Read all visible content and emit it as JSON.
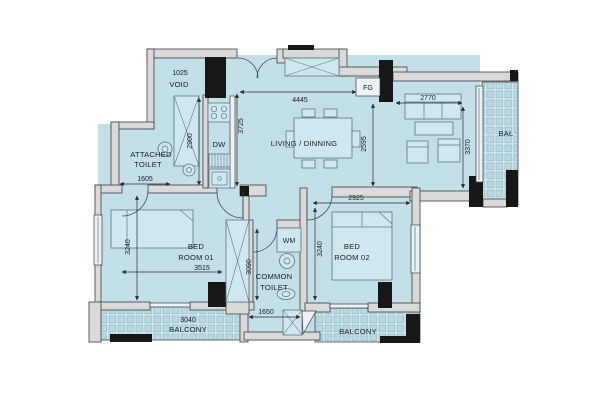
{
  "plan": {
    "rooms": {
      "void": {
        "dim": "1025",
        "label": "VOID"
      },
      "attached_toilet": {
        "line1": "ATTACHED",
        "line2": "TOILET",
        "width_dim": "1605"
      },
      "kitchen": {
        "dishwasher_label": "DW"
      },
      "living_dining": {
        "label": "LIVING / DINNING",
        "fg_label": "FG"
      },
      "bedroom_01": {
        "line1": "BED",
        "line2": "ROOM 01",
        "width_dim": "3515",
        "height_dim": "3240"
      },
      "bedroom_02": {
        "line1": "BED",
        "line2": "ROOM 02",
        "width_dim": "2925",
        "height_dim": "3240"
      },
      "common_toilet": {
        "line1": "COMMON",
        "line2": "TOILET",
        "height_dim": "3090",
        "opening_dim": "1650",
        "washing_machine_label": "WM"
      },
      "balcony_sw": {
        "dim": "3040",
        "label": "BALCONY"
      },
      "balcony_se": {
        "label": "BALCONY"
      },
      "balcony_east": {
        "label": "BAL"
      }
    },
    "dimensions": {
      "living_width": "4445",
      "living_depth": "2595",
      "kitchen_run": "3725",
      "hall_depth": "2900",
      "sofa_wall": "2770",
      "balcony_east_run": "3370"
    },
    "colors": {
      "floor": "#c3dfe8",
      "balcony_bg": "#cde4eb",
      "balcony_tile": "#b9d8e2",
      "wall_fill": "#dadada",
      "wall_edge": "#3d3d3d",
      "column": "#171717",
      "furniture": "#cfe7ee",
      "furniture_edge": "#5d7682",
      "glass": "#eaf3f6",
      "dim": "#2a2a2a",
      "text": "#1d1d1d"
    }
  }
}
